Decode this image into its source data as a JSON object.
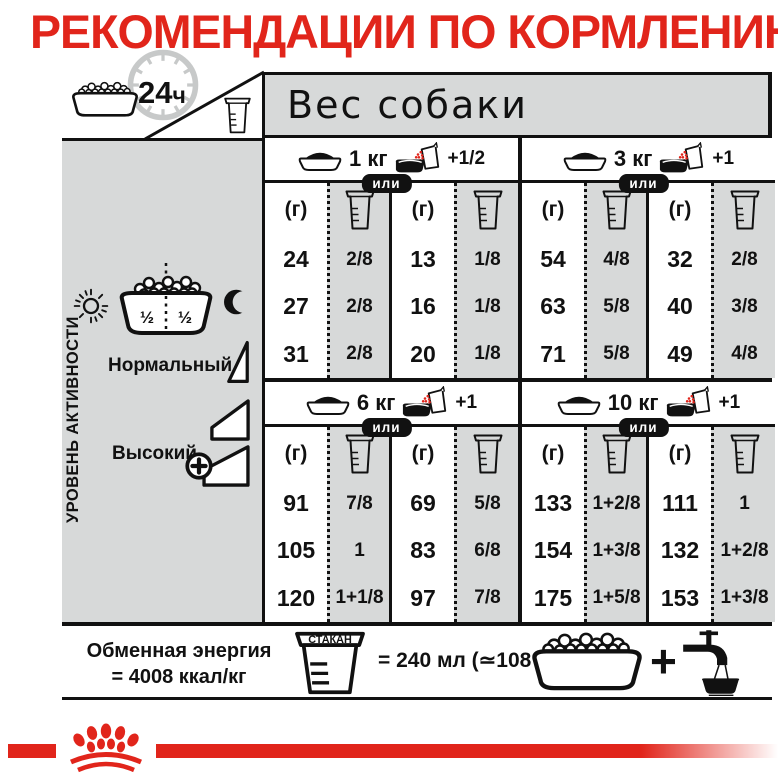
{
  "title": "РЕКОМЕНДАЦИИ ПО КОРМЛЕНИЮ",
  "colors": {
    "brand_red": "#e1251b",
    "panel_gray": "#d7d9d9",
    "ink": "#111111"
  },
  "header": {
    "daily_value": "24",
    "daily_unit": "ч",
    "weight_title": "Вес собаки"
  },
  "sidebar": {
    "axis_label": "УРОВЕНЬ АКТИВНОСТИ",
    "split_left": "½",
    "split_right": "½",
    "normal_label": "Нормальный",
    "high_label": "Высокий"
  },
  "table": {
    "or_label": "или",
    "grams_label": "(г)",
    "groups": [
      {
        "weight": "1 кг",
        "wet_extra": "+1/2",
        "dry_grams": [
          "24",
          "27",
          "31"
        ],
        "dry_cups": [
          "2/8",
          "2/8",
          "2/8"
        ],
        "mix_grams": [
          "13",
          "16",
          "20"
        ],
        "mix_cups": [
          "1/8",
          "1/8",
          "1/8"
        ]
      },
      {
        "weight": "3 кг",
        "wet_extra": "+1",
        "dry_grams": [
          "54",
          "63",
          "71"
        ],
        "dry_cups": [
          "4/8",
          "5/8",
          "5/8"
        ],
        "mix_grams": [
          "32",
          "40",
          "49"
        ],
        "mix_cups": [
          "2/8",
          "3/8",
          "4/8"
        ]
      },
      {
        "weight": "6 кг",
        "wet_extra": "+1",
        "dry_grams": [
          "91",
          "105",
          "120"
        ],
        "dry_cups": [
          "7/8",
          "1",
          "1+1/8"
        ],
        "mix_grams": [
          "69",
          "83",
          "97"
        ],
        "mix_cups": [
          "5/8",
          "6/8",
          "7/8"
        ]
      },
      {
        "weight": "10 кг",
        "wet_extra": "+1",
        "dry_grams": [
          "133",
          "154",
          "175"
        ],
        "dry_cups": [
          "1+2/8",
          "1+3/8",
          "1+5/8"
        ],
        "mix_grams": [
          "111",
          "132",
          "153"
        ],
        "mix_cups": [
          "1",
          "1+2/8",
          "1+3/8"
        ]
      }
    ]
  },
  "footer": {
    "energy_line1": "Обменная энергия",
    "energy_line2": "= 4008 ккал/кг",
    "cup_label": "СТАКАН",
    "cup_equiv": "= 240 мл (≃108 г)",
    "plus_sign": "+"
  },
  "icons": {
    "kibble-bowl-icon": "bowl filled with dry kibble",
    "clock-icon": "24-hour clock dial",
    "measuring-cup-icon": "measuring cup with level marks",
    "food-bowl-icon": "bowl with mound of food",
    "wet-pouch-bowl-icon": "wet food pouch added to bowl",
    "sun-icon": "sun (day feeding)",
    "moon-icon": "crescent moon (night feeding)",
    "half-split-bowl-icon": "bowl split into two half portions",
    "activity-step-icon": "activity level ramp step",
    "plus-circle-icon": "circled plus (increase)",
    "water-tap-icon": "tap filling a water bowl",
    "crown-logo-icon": "crown of red dots (brand logo)"
  }
}
